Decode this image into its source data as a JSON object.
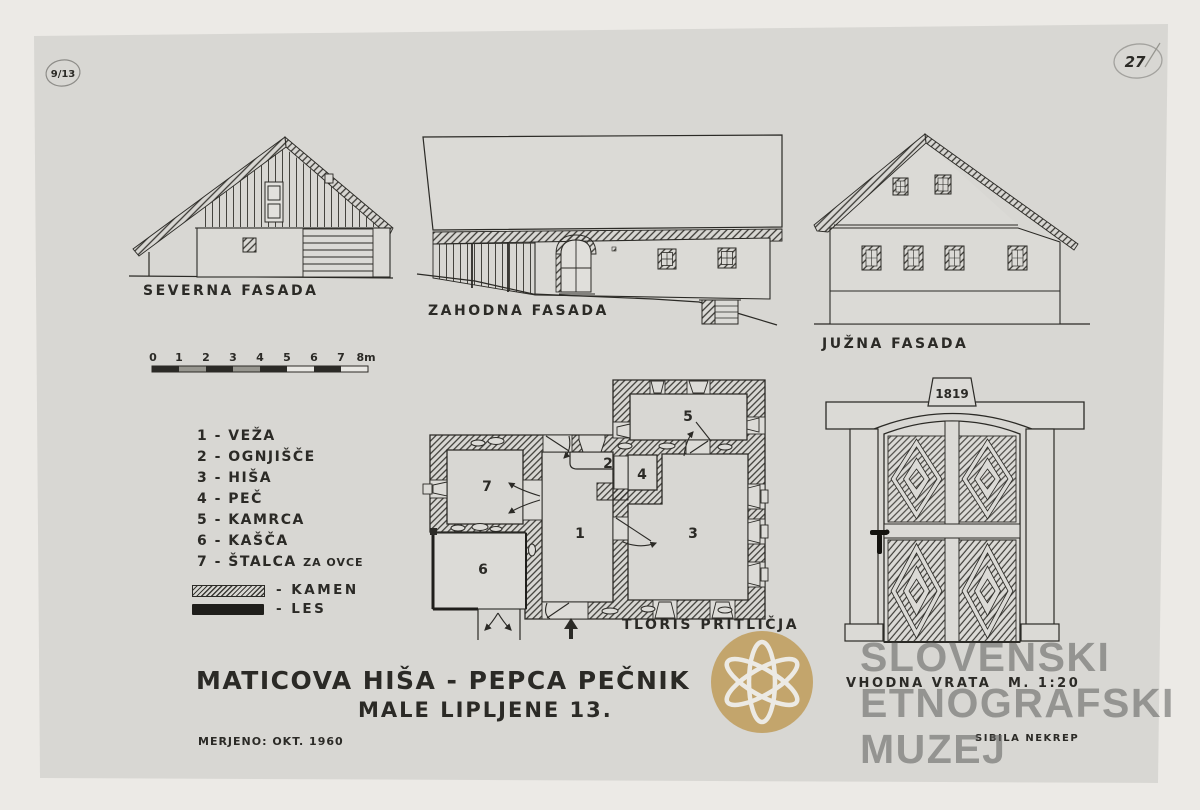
{
  "page": {
    "background": "#eceae6",
    "paper_color": "#d8d7d3",
    "ink_color": "#2b2a26",
    "pencil_color": "#8d8c88",
    "logo_gold": "#c2a267",
    "watermark_gray": "#686866"
  },
  "marks": {
    "top_left": "9/13",
    "top_right": "27"
  },
  "facades": {
    "north": {
      "label": "SEVERNA FASADA"
    },
    "west": {
      "label": "ZAHODNA FASADA"
    },
    "south": {
      "label": "JUŽNA FASADA"
    }
  },
  "scale_bar": {
    "ticks": [
      "0",
      "1",
      "2",
      "3",
      "4",
      "5",
      "6",
      "7",
      "8m"
    ]
  },
  "legend": {
    "items": [
      "1 - VEŽA",
      "2 - OGNJIŠČE",
      "3 - HIŠA",
      "4 - PEČ",
      "5 - KAMRCA",
      "6 - KAŠČA",
      "7 - ŠTALCA"
    ],
    "item7_suffix": "ZA OVCE"
  },
  "materials": {
    "stone": "- KAMEN",
    "wood": "- LES"
  },
  "plan": {
    "label": "TLORIS PRITLIČJA",
    "rooms": [
      "1",
      "2",
      "3",
      "4",
      "5",
      "6",
      "7"
    ]
  },
  "door": {
    "label": "VHODNA VRATA",
    "scale": "M. 1:20",
    "keystone_year": "1819",
    "author": "SIBILA NEKREP"
  },
  "title": {
    "line1": "MATICOVA HIŠA - PEPCA PEČNIK",
    "line2": "MALE LIPLJENE 13.",
    "measured": "MERJENO: OKT. 1960"
  },
  "watermark": {
    "line1": "SLOVENSKI",
    "line2": "ETNOGRAFSKI",
    "line3": "MUZEJ"
  }
}
